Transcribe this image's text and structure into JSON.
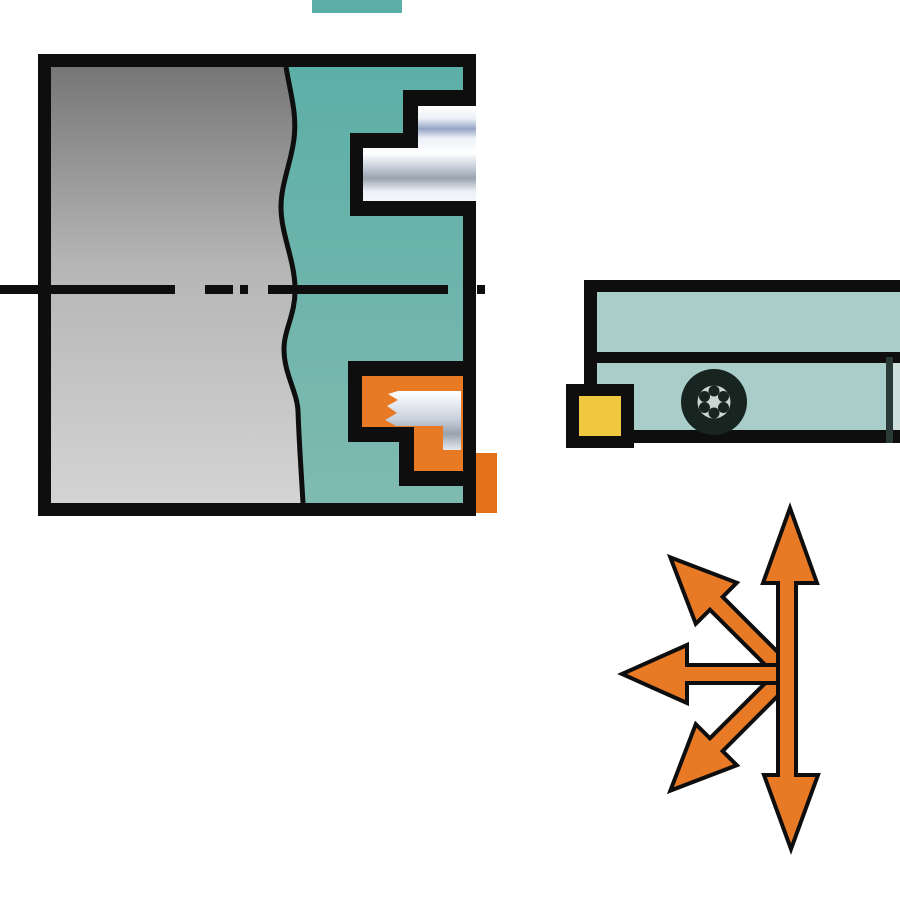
{
  "illustration": {
    "kind": "machining-operation-diagram",
    "workpiece_label": "workpiece-cross-section",
    "upper_feature_label": "machined-groove-profile",
    "lower_feature_label": "groove-with-engaged-insert",
    "tool_label": "grooving-tool-holder",
    "insert_label": "cutting-insert",
    "screw_label": "clamp-screw",
    "arrows_label": "multi-direction-feed-arrows"
  },
  "colors": {
    "background": "#FFFFFF",
    "outline": "#0E0E0E",
    "workpiece_teal": "#5CAFA7",
    "workpiece_teal_light": "#7FBAB0",
    "gray_top": "#767676",
    "gray_mid": "#B5B5B5",
    "gray_bottom": "#D4D4D4",
    "holder_teal": "#A9CECA",
    "orange": "#E87A26",
    "orange_tab": "#E27119",
    "insert_yellow": "#F0C83E",
    "metal_white": "#FFFFFF",
    "metal_light": "#EDF1F7",
    "metal_blue": "#96A5C6",
    "metal_gray": "#98A3AD",
    "metal_silver": "#CBD3DF",
    "screw_dark": "#182420",
    "screw_light": "#C9D6D2",
    "holder_edge_dark": "#2A3A36",
    "holder_edge_light": "#CFE0DC"
  }
}
